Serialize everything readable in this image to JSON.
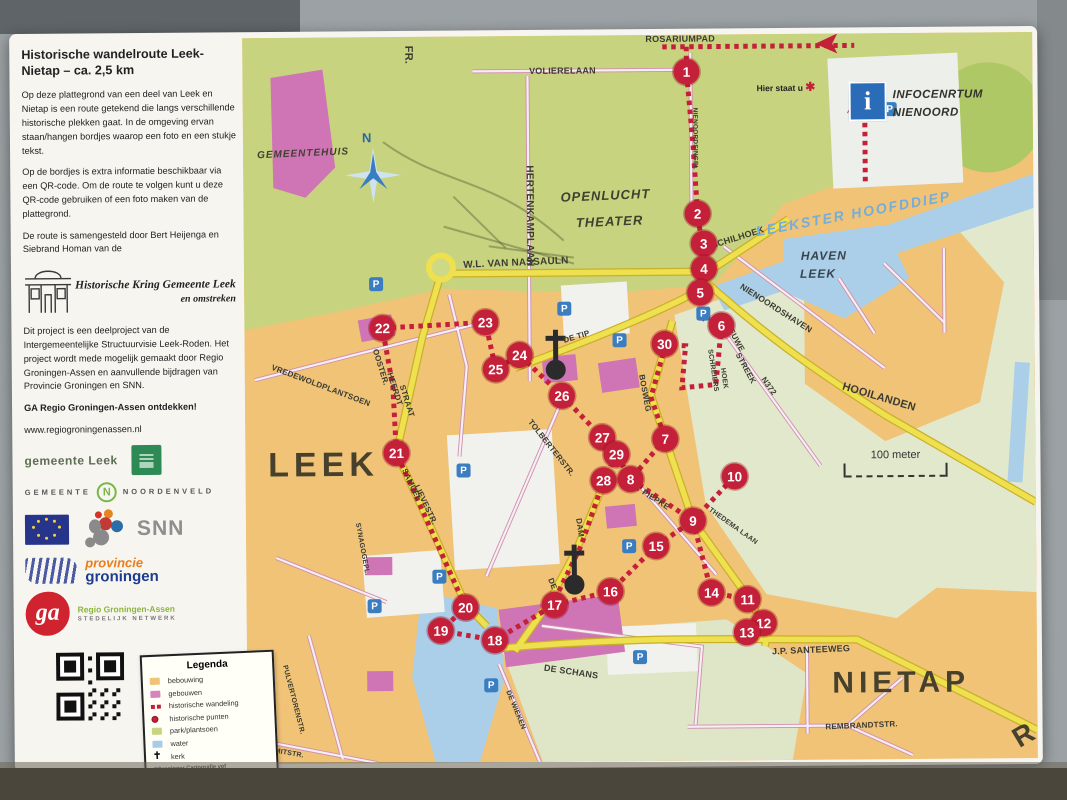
{
  "panel": {
    "title": "Historische wandelroute Leek-Nietap – ca. 2,5 km",
    "p1": "Op deze plattegrond van een deel van Leek en Nietap is een route getekend die langs verschillende historische plekken gaat. In de omgeving ervan staan/hangen bordjes waarop een foto en een stukje tekst.",
    "p2": "Op de bordjes is extra informatie beschikbaar via een QR-code. Om de route te volgen kunt u deze QR-code gebruiken of een foto maken van de plattegrond.",
    "p3": "De route is samengesteld door Bert Heijenga en Siebrand Homan van de",
    "kring_line1": "Historische Kring Gemeente Leek",
    "kring_line2": "en omstreken",
    "p4": "Dit project is een deelproject van de Intergemeentelijke Structuurvisie Leek-Roden. Het project wordt mede mogelijk gemaakt door Regio Groningen-Assen en aanvullende bijdragen van Provincie Groningen en SNN.",
    "cta": "GA Regio Groningen-Assen ontdekken!",
    "website": "www.regiogroningenassen.nl",
    "logos": {
      "gemeente_leek": "gemeente Leek",
      "noordenveld_prefix": "GEMEENTE",
      "noordenveld_n": "N",
      "noordenveld_name": "NOORDENVELD",
      "snn": "SNN",
      "provincie_line1": "provincie",
      "provincie_line2": "groningen",
      "ga": "ga",
      "ga_line1": "Regio Groningen-Assen",
      "ga_line2": "STEDELIJK NETWERK"
    }
  },
  "legend": {
    "title": "Legenda",
    "items": [
      {
        "label": "bebouwing",
        "type": "swatch",
        "color": "#f0c377"
      },
      {
        "label": "gebouwen",
        "type": "swatch",
        "color": "#d884bc"
      },
      {
        "label": "historische wandeling",
        "type": "route",
        "color": "#c5203a"
      },
      {
        "label": "historische punten",
        "type": "dot",
        "color": "#c5203a"
      },
      {
        "label": "park/plantsoen",
        "type": "swatch",
        "color": "#c8d57f"
      },
      {
        "label": "water",
        "type": "swatch",
        "color": "#a8cce8"
      },
      {
        "label": "kerk",
        "type": "church",
        "color": "#222222"
      }
    ],
    "credit1": "©Groninger Cartografie vof",
    "credit2": "www.groningercartografie.nl"
  },
  "map": {
    "infocentrum_line1": "INFOCENRTUM",
    "infocentrum_line2": "NIENOORD",
    "infocentrum_icon": "i",
    "you_are_here": "Hier staat u",
    "scale_label": "100 meter",
    "compass_label": "N",
    "parking_label": "P",
    "route_color": "#c5203a",
    "labels": [
      {
        "text": "FR.",
        "x": 166,
        "y": 18,
        "rot": 90,
        "size": 11
      },
      {
        "text": "HERTENKAMPLAAN",
        "x": 286,
        "y": 180,
        "rot": 90,
        "size": 10
      },
      {
        "text": "VOLIERELAAN",
        "x": 320,
        "y": 35,
        "rot": 0,
        "size": 9
      },
      {
        "text": "ROSARIUMPAD",
        "x": 438,
        "y": 4,
        "rot": 0,
        "size": 9
      },
      {
        "text": "NIENOORDSINGEL",
        "x": 452,
        "y": 104,
        "rot": 90,
        "size": 6.5
      },
      {
        "text": "OPENLUCHT",
        "x": 362,
        "y": 160,
        "rot": -2,
        "size": 13,
        "cls": "it"
      },
      {
        "text": "THEATER",
        "x": 366,
        "y": 186,
        "rot": -2,
        "size": 13,
        "cls": "it"
      },
      {
        "text": "GEMEENTEHUIS",
        "x": 60,
        "y": 116,
        "rot": -2,
        "size": 10,
        "cls": "it"
      },
      {
        "text": "SCHILHOEK",
        "x": 494,
        "y": 203,
        "rot": -17,
        "size": 9
      },
      {
        "text": "LEEKSTER HOOFDDIEP",
        "x": 610,
        "y": 180,
        "rot": -10,
        "size": 14,
        "cls": "water"
      },
      {
        "text": "HAVEN",
        "x": 580,
        "y": 222,
        "rot": 0,
        "size": 12,
        "cls": "ithv"
      },
      {
        "text": "LEEK",
        "x": 574,
        "y": 240,
        "rot": 0,
        "size": 12,
        "cls": "ithv"
      },
      {
        "text": "NIENOORDSHAVEN",
        "x": 532,
        "y": 274,
        "rot": 33,
        "size": 8.5
      },
      {
        "text": "N372",
        "x": 524,
        "y": 352,
        "rot": 55,
        "size": 8
      },
      {
        "text": "HOOILANDEN",
        "x": 634,
        "y": 364,
        "rot": 17,
        "size": 11
      },
      {
        "text": "W.L. VAN NASSAULN",
        "x": 272,
        "y": 227,
        "rot": -2,
        "size": 10
      },
      {
        "text": "DE TIP",
        "x": 332,
        "y": 301,
        "rot": -16,
        "size": 8
      },
      {
        "text": "NIEUWE",
        "x": 490,
        "y": 302,
        "rot": 62,
        "size": 8
      },
      {
        "text": "STREEK",
        "x": 501,
        "y": 334,
        "rot": 62,
        "size": 8
      },
      {
        "text": "BOSWEG",
        "x": 400,
        "y": 358,
        "rot": 80,
        "size": 8
      },
      {
        "text": "SCHREIERS",
        "x": 468,
        "y": 336,
        "rot": 82,
        "size": 7
      },
      {
        "text": "HOEK",
        "x": 479,
        "y": 344,
        "rot": 82,
        "size": 7
      },
      {
        "text": "VREDEWOLDPLANTSOEN",
        "x": 76,
        "y": 348,
        "rot": 21,
        "size": 8
      },
      {
        "text": "OOSTER.",
        "x": 136,
        "y": 330,
        "rot": 73,
        "size": 8
      },
      {
        "text": "HEERDT",
        "x": 150,
        "y": 352,
        "rot": 73,
        "size": 8
      },
      {
        "text": "STRAAT",
        "x": 162,
        "y": 364,
        "rot": 73,
        "size": 8
      },
      {
        "text": "LEEK",
        "x": 78,
        "y": 428,
        "rot": 0,
        "size": 34,
        "cls": "town"
      },
      {
        "text": "SAMUEL",
        "x": 166,
        "y": 448,
        "rot": 65,
        "size": 8
      },
      {
        "text": "LIEVESTR.",
        "x": 180,
        "y": 468,
        "rot": 65,
        "size": 8
      },
      {
        "text": "SYNAGOGEPL.",
        "x": 116,
        "y": 512,
        "rot": 80,
        "size": 7
      },
      {
        "text": "TOLBERTERSTR.",
        "x": 306,
        "y": 412,
        "rot": 52,
        "size": 8
      },
      {
        "text": "'T PIEPKE",
        "x": 406,
        "y": 462,
        "rot": 33,
        "size": 8
      },
      {
        "text": "THEDEMA LAAN",
        "x": 487,
        "y": 492,
        "rot": 36,
        "size": 7
      },
      {
        "text": "DAM",
        "x": 334,
        "y": 492,
        "rot": 82,
        "size": 8
      },
      {
        "text": "DE",
        "x": 306,
        "y": 548,
        "rot": 68,
        "size": 8
      },
      {
        "text": "DE SCHANS",
        "x": 324,
        "y": 636,
        "rot": 9,
        "size": 9
      },
      {
        "text": "DE WIEKEN",
        "x": 268,
        "y": 674,
        "rot": 68,
        "size": 7
      },
      {
        "text": "PULVERTORENSTR.",
        "x": 46,
        "y": 662,
        "rot": 76,
        "size": 7
      },
      {
        "text": "F.J. SMITSTR.",
        "x": 32,
        "y": 714,
        "rot": 10,
        "size": 7
      },
      {
        "text": "J.P. SANTEEWEG",
        "x": 564,
        "y": 616,
        "rot": -2,
        "size": 9
      },
      {
        "text": "NIETAP",
        "x": 654,
        "y": 650,
        "rot": 0,
        "size": 30,
        "cls": "town"
      },
      {
        "text": "REMBRANDTSTR.",
        "x": 614,
        "y": 692,
        "rot": -2,
        "size": 8
      },
      {
        "text": "R",
        "x": 778,
        "y": 702,
        "rot": -30,
        "size": 28,
        "cls": "town"
      }
    ],
    "markers": [
      {
        "n": "1",
        "x": 444,
        "y": 37
      },
      {
        "n": "2",
        "x": 454,
        "y": 179
      },
      {
        "n": "3",
        "x": 460,
        "y": 209
      },
      {
        "n": "4",
        "x": 460,
        "y": 234
      },
      {
        "n": "5",
        "x": 456,
        "y": 258
      },
      {
        "n": "6",
        "x": 477,
        "y": 291
      },
      {
        "n": "7",
        "x": 420,
        "y": 404
      },
      {
        "n": "8",
        "x": 385,
        "y": 444
      },
      {
        "n": "9",
        "x": 447,
        "y": 486
      },
      {
        "n": "10",
        "x": 489,
        "y": 442
      },
      {
        "n": "11",
        "x": 501,
        "y": 565
      },
      {
        "n": "12",
        "x": 517,
        "y": 589
      },
      {
        "n": "13",
        "x": 500,
        "y": 598
      },
      {
        "n": "14",
        "x": 465,
        "y": 558
      },
      {
        "n": "15",
        "x": 410,
        "y": 511
      },
      {
        "n": "16",
        "x": 364,
        "y": 556
      },
      {
        "n": "17",
        "x": 308,
        "y": 569
      },
      {
        "n": "18",
        "x": 248,
        "y": 604
      },
      {
        "n": "19",
        "x": 194,
        "y": 594
      },
      {
        "n": "20",
        "x": 219,
        "y": 571
      },
      {
        "n": "21",
        "x": 151,
        "y": 416
      },
      {
        "n": "22",
        "x": 138,
        "y": 291
      },
      {
        "n": "23",
        "x": 241,
        "y": 286
      },
      {
        "n": "24",
        "x": 275,
        "y": 319
      },
      {
        "n": "25",
        "x": 251,
        "y": 333
      },
      {
        "n": "26",
        "x": 317,
        "y": 360
      },
      {
        "n": "27",
        "x": 357,
        "y": 402
      },
      {
        "n": "28",
        "x": 358,
        "y": 445
      },
      {
        "n": "29",
        "x": 371,
        "y": 419
      },
      {
        "n": "30",
        "x": 420,
        "y": 309
      }
    ],
    "parking": [
      {
        "x": 132,
        "y": 247
      },
      {
        "x": 320,
        "y": 273
      },
      {
        "x": 375,
        "y": 305
      },
      {
        "x": 459,
        "y": 279
      },
      {
        "x": 647,
        "y": 76
      },
      {
        "x": 383,
        "y": 511
      },
      {
        "x": 393,
        "y": 622
      },
      {
        "x": 193,
        "y": 540
      },
      {
        "x": 128,
        "y": 569
      },
      {
        "x": 244,
        "y": 649
      },
      {
        "x": 218,
        "y": 434
      }
    ]
  }
}
